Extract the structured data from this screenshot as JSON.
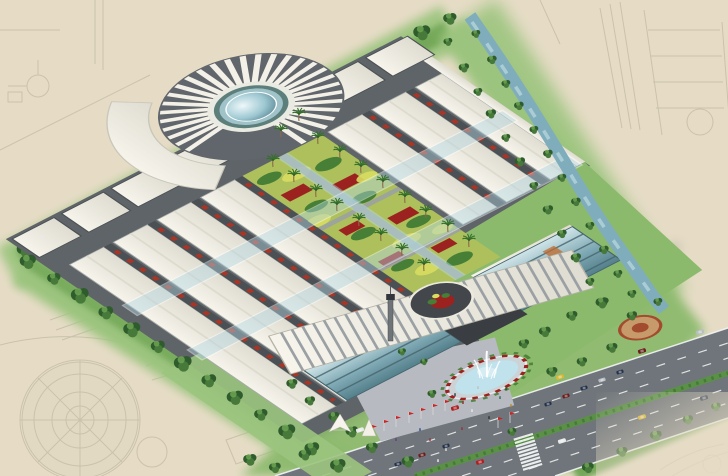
{
  "scene": {
    "type": "architectural-aerial-rendering",
    "description": "Bird's-eye perspective rendering of a large commercial market complex: rows of white-roofed market halls around a landscaped central courtyard with palm trees, a glass-domed rotunda with radial fan roof at the rear, a curved louvered entrance building with a circular roof cutout and fountain plaza in front, perimeter tree rows, a tree-lined canal on the upper right, and a multi-lane road at the lower right, all drawn over a faint beige site-plan sketch.",
    "buildings": [
      {
        "name": "rotunda-hall",
        "feature": "glass dome with radial fan roof and crescent canopy"
      },
      {
        "name": "market-halls",
        "count": 7,
        "feature": "long white roofs, dark side walls, red shopfront bands"
      },
      {
        "name": "back-row-shops",
        "count": 6
      },
      {
        "name": "entrance-building",
        "feature": "curved louvered roof with circular cutout over red flower court, two glass curtain-wall wings"
      }
    ],
    "landscape": {
      "central_courtyard": "yellow-green planting with red flower beds, clipped shrubs and palm trees",
      "palms": 18,
      "perimeter_trees": "dense rows on all sides",
      "canal": "tree-lined, flowing along upper-right edge",
      "east_lawn_feature": "circular flower medallion",
      "tents": 2
    },
    "plaza": {
      "fountain_jets": 6,
      "flags": 9,
      "flag_color_name": "red",
      "people_visible": 14
    },
    "road": {
      "type": "dual carriageway with planted median",
      "crosswalk": true,
      "moving_cars": 9,
      "parked_cars": 8
    }
  },
  "palette": {
    "bg": "#e6dcc6",
    "sketch": "#8b8870",
    "sketch_fill": "#b9bfa6",
    "grass": "#9bc47e",
    "grass_deep": "#6ba14f",
    "lawn": "#8cba6d",
    "tree_dark": "#2f5c2c",
    "tree_mid": "#47793a",
    "tree_light": "#6ca352",
    "river": "#7fadbb",
    "river_hi": "#bcdae0",
    "roof": "#f2f0e7",
    "roof_dim": "#dddbce",
    "roof_line": "#a6aba8",
    "wall": "#4b5054",
    "asphalt": "#5f6468",
    "plaza": "#b7bbc1",
    "glass_deep": "#46646d",
    "accent_red": "#a93527",
    "court_base": "#aec05c",
    "court_yellow": "#d8dc60",
    "court_green": "#467f35",
    "court_red": "#9c2220",
    "path_gray": "#9aa0a4",
    "road": "#6f757a",
    "road_line": "#f4f6f6",
    "median": "#5a9147",
    "flag": "#d31f1f",
    "fountain_water": "#bfe2ec",
    "basin": "#cdd2d5",
    "car_red": "#ae1f1f",
    "car_yellow": "#d9b835",
    "car_white": "#e9eaea",
    "car_dark": "#263249",
    "car_silver": "#b9bec4",
    "car_maroon": "#6b1d1d",
    "medallion": "#c79a6b",
    "medallion_ring": "#a34b2e",
    "tower": "#6e7478"
  }
}
